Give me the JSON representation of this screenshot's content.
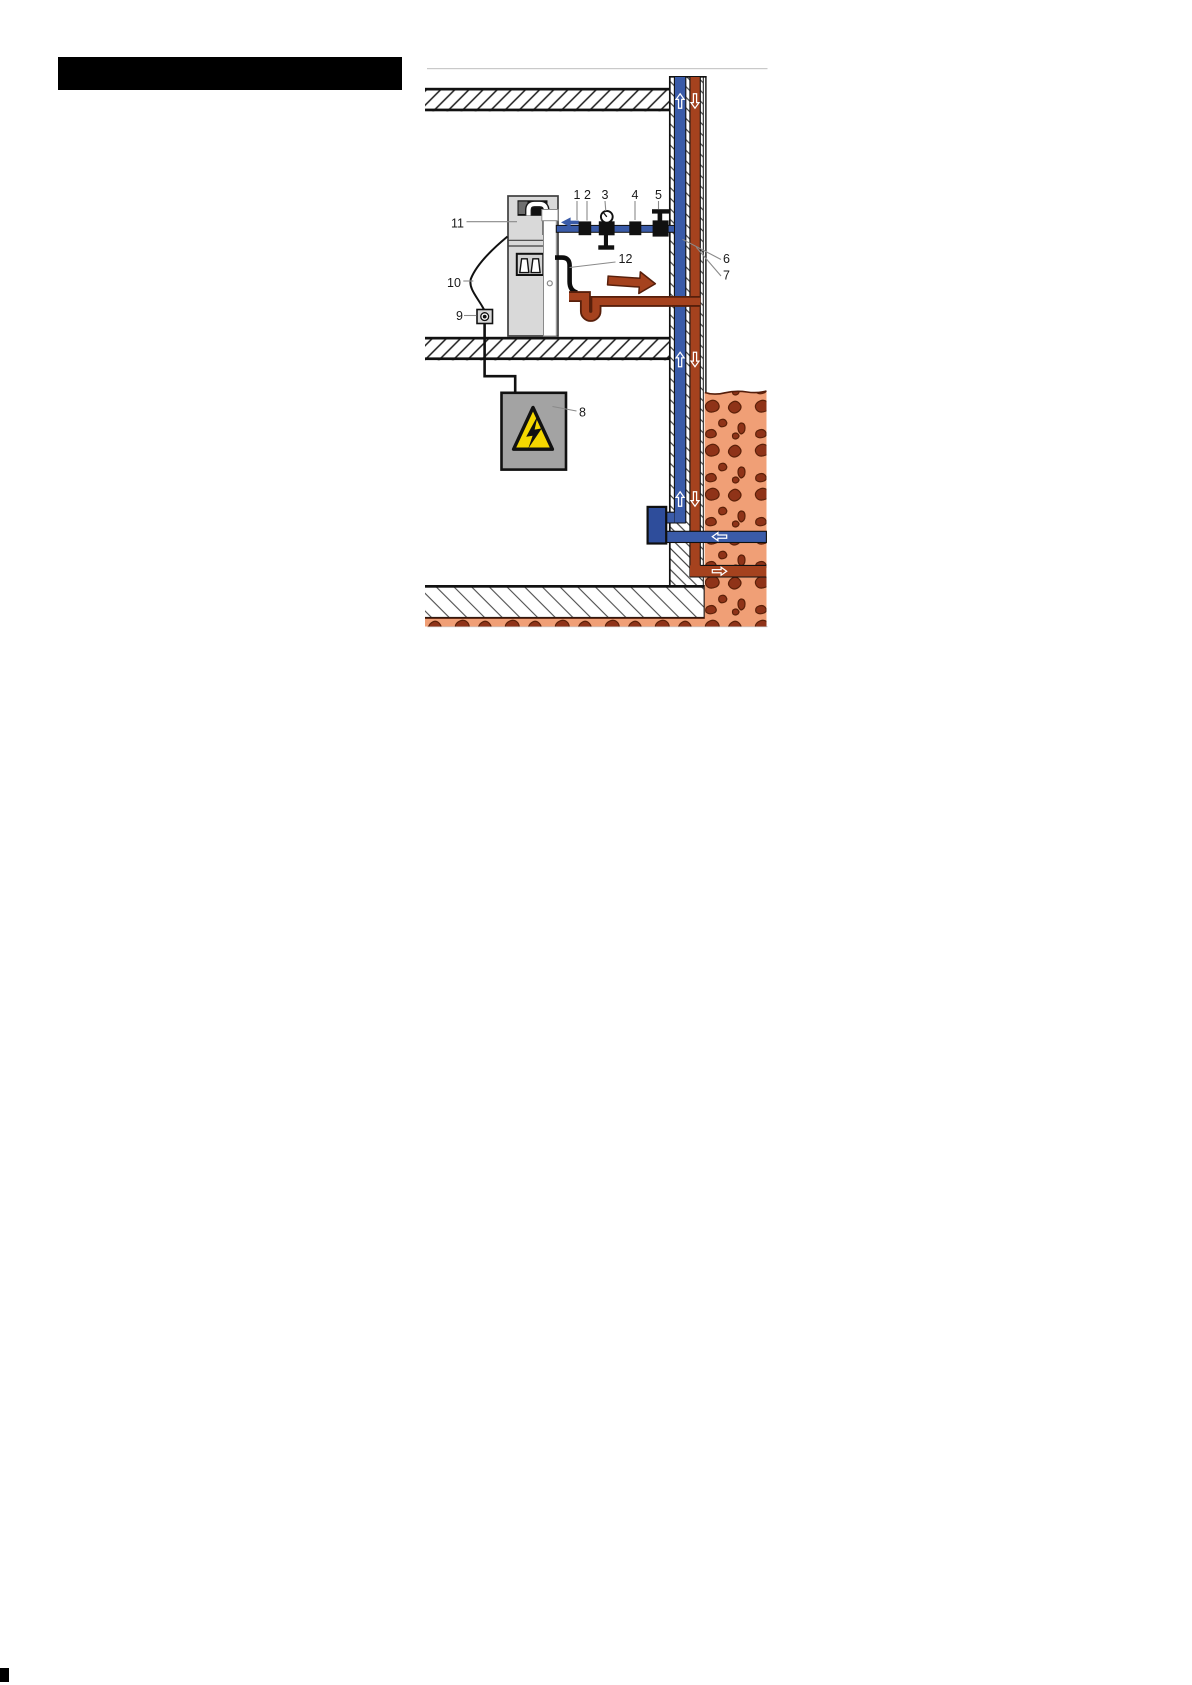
{
  "figure": {
    "type": "appliance-installation-diagram",
    "callouts": [
      "1",
      "2",
      "3",
      "4",
      "5",
      "6",
      "7",
      "8",
      "9",
      "10",
      "11",
      "12"
    ],
    "colors": {
      "cold_water_blue": "#3A5BA8",
      "supply_fitting_blue": "#2E4D9B",
      "waste_brown": "#A5421E",
      "waste_outline": "#571F0B",
      "soil_orange": "#F09F76",
      "soil_clod": "#8F3318",
      "warning_yellow": "#F5D700",
      "appliance_gray": "#D9D9D9",
      "junction_box_gray": "#A3A3A3"
    }
  }
}
